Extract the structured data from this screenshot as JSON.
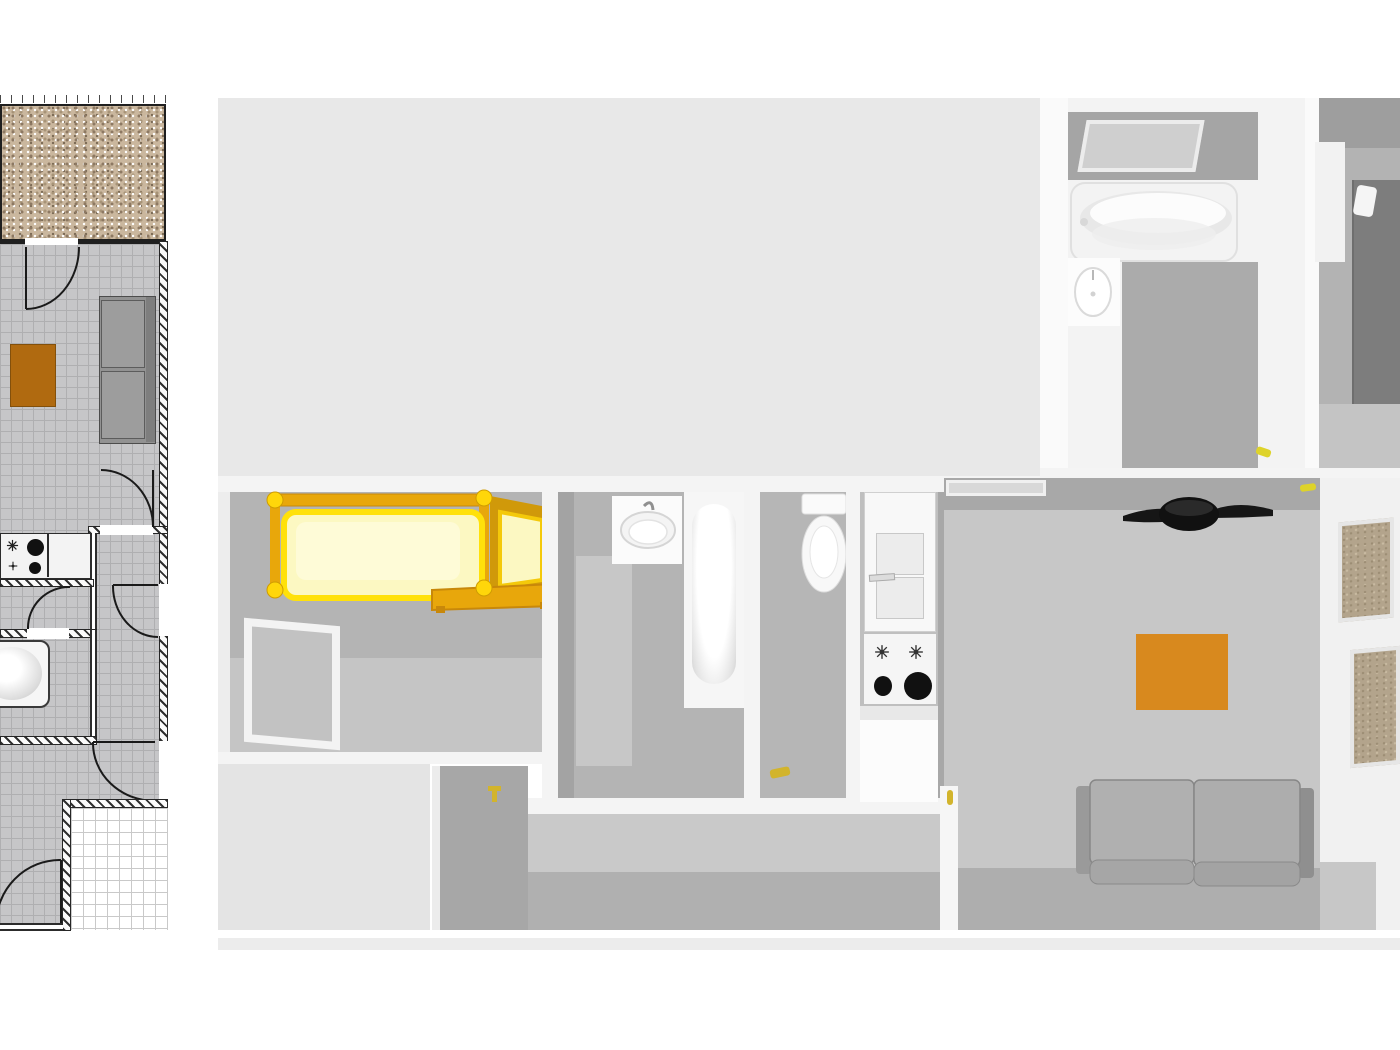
{
  "title": "apartment floor plan — 2D drawing and 3D top-down render",
  "colors": {
    "page_bg": "#ffffff",
    "plan_floor": "#c6c6c8",
    "plan_grid": "#afafb1",
    "wall_dark": "#1f1f1f",
    "gravel_base": "#cab79e",
    "gravel_dark": "#8d7963",
    "gravel_mid": "#a79377",
    "rug_2d": "#b06a10",
    "sofa_2d": "#929292",
    "graph_line": "#c9c9c9",
    "graph_line_strong": "#909090",
    "bg_3d": "#e8e8e8",
    "terrace_3d": "#e4e4e4",
    "wall_white": "#f4f4f4",
    "room_wall": "#b4b4b4",
    "room_wall_dark": "#a3a3a3",
    "floor_3d": "#c7c7c7",
    "floor_3d_dark": "#aeaeae",
    "ceiling_dark": "#9e9e9e",
    "fixture_white": "#f8f8f8",
    "rug_3d": "#d8891e",
    "bed_frame_gold": "#e8a70b",
    "bed_frame_deep": "#c8880a",
    "mattress_pale": "#fcf8c2",
    "mattress_edge": "#ffe10a",
    "knob_ball": "#ffd60a",
    "bed_dark_gray": "#7d7d7d",
    "sofa_3d": "#b0b0b0",
    "fan_black": "#161616",
    "tan_panel": "#b3a48c",
    "handle_yellow": "#d2b42c",
    "burner_black": "#111111"
  },
  "panels": {
    "plan2d": {
      "name": "2d-floor-plan",
      "elements": [
        "ruler-ticks",
        "gravel-terrace",
        "living-room-grid-floor",
        "door-arcs",
        "orange-rug",
        "sofa-top-view",
        "stove-counter",
        "bathtub",
        "hatched-walls",
        "graph-paper-patch"
      ]
    },
    "view3d": {
      "name": "3d-floor-plan-render",
      "rooms": [
        "terrace",
        "bathroom-top",
        "bedroom-right",
        "bedroom-yellow-bed",
        "bathroom-middle",
        "wc",
        "kitchen",
        "living-room",
        "hallway"
      ],
      "furniture": [
        "skylight-window",
        "bathtub-top",
        "round-sink",
        "dark-bed",
        "yellow-frame-bed",
        "wall-window",
        "square-sink",
        "vertical-bathtub",
        "toilet",
        "fridge",
        "stove-burners",
        "kitchen-counter",
        "ceiling-vent",
        "ceiling-fan",
        "orange-rug",
        "gray-sofa",
        "door-leaf",
        "tan-door-panels"
      ],
      "accent_marks": [
        "yellow-door-handles"
      ]
    }
  }
}
